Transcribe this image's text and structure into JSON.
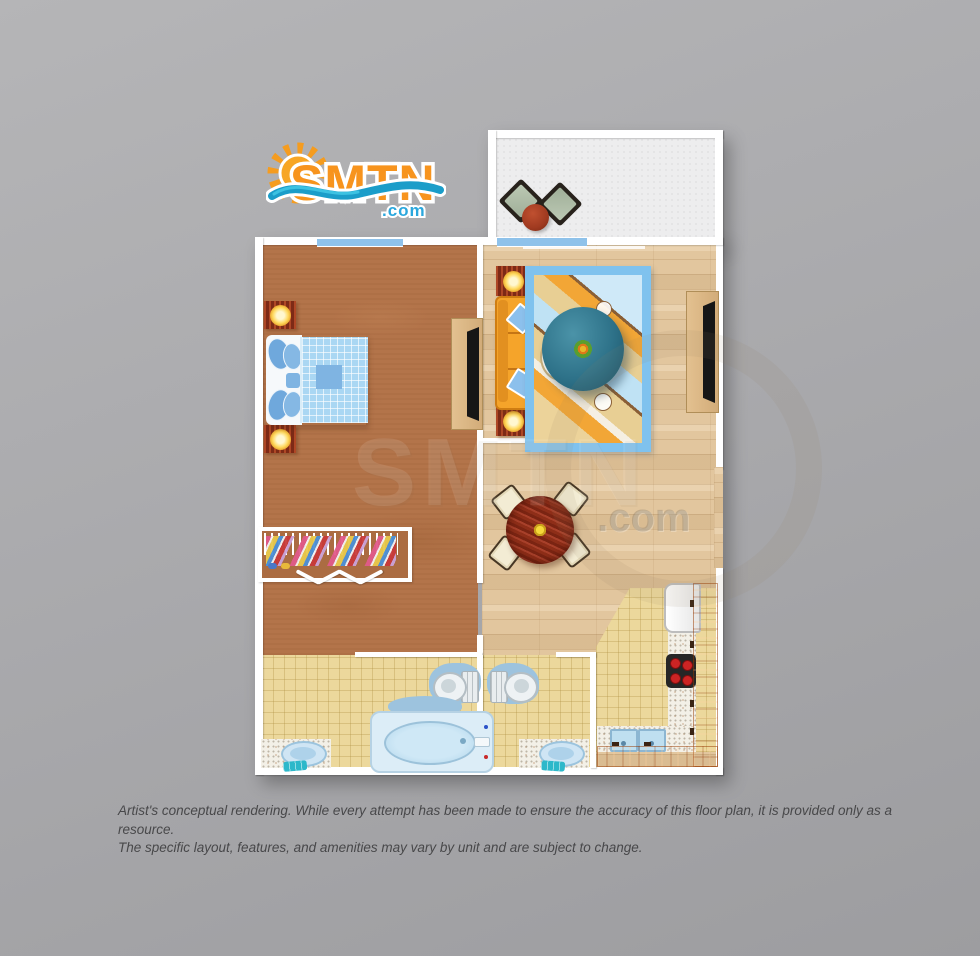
{
  "logo": {
    "text": "SMTN",
    "tld": ".com"
  },
  "watermark": {
    "text": "SMTN",
    "tld": ".com"
  },
  "disclaimer": {
    "line1": "Artist's conceptual rendering. While every attempt has been made to ensure the accuracy of this floor plan, it is provided only as a resource.",
    "line2": "The specific layout, features, and amenities may vary by unit and are subject to change."
  },
  "floor_plan": {
    "type": "one-bedroom-unit-floor-plan",
    "rooms": [
      "balcony",
      "bedroom",
      "living-room",
      "dining-area",
      "kitchen",
      "bathroom-1",
      "bathroom-2"
    ],
    "furniture": {
      "balcony": [
        "patio-chair",
        "patio-chair",
        "round-patio-table"
      ],
      "bedroom": [
        "nightstand-with-lamp",
        "double-bed",
        "nightstand-with-lamp",
        "closet-with-clothes",
        "tv-console"
      ],
      "living_room": [
        "end-table-with-lamp",
        "orange-sofa",
        "end-table-with-lamp",
        "area-rug",
        "oval-coffee-table",
        "tv-console"
      ],
      "dining_area": [
        "round-dining-table",
        "dining-chair",
        "dining-chair",
        "dining-chair",
        "dining-chair"
      ],
      "kitchen": [
        "refrigerator",
        "stove-with-burners",
        "counter",
        "double-sink",
        "orange-cabinets"
      ],
      "bathroom_1": [
        "vanity-sink",
        "toilet",
        "bath-mat",
        "bathtub"
      ],
      "bathroom_2": [
        "toilet",
        "vanity-sink"
      ]
    },
    "colors": {
      "background_gray": "#aaaaad",
      "wall_white": "#ffffff",
      "carpet_brown": "#b3744a",
      "wood_floor": "#e2c69e",
      "tile_floor": "#ecd89c",
      "balcony_floor": "#ededee",
      "cabinet_orange": "#ee7212",
      "sofa_orange": "#f5a42a",
      "bedding_blue": "#aad7f3",
      "rug_blue": "#7fc2ee",
      "logo_orange": "#f7941e",
      "logo_blue": "#2ba7dd",
      "wave_teal": "#1b9dc9",
      "disclaimer_text": "#48484a"
    }
  }
}
